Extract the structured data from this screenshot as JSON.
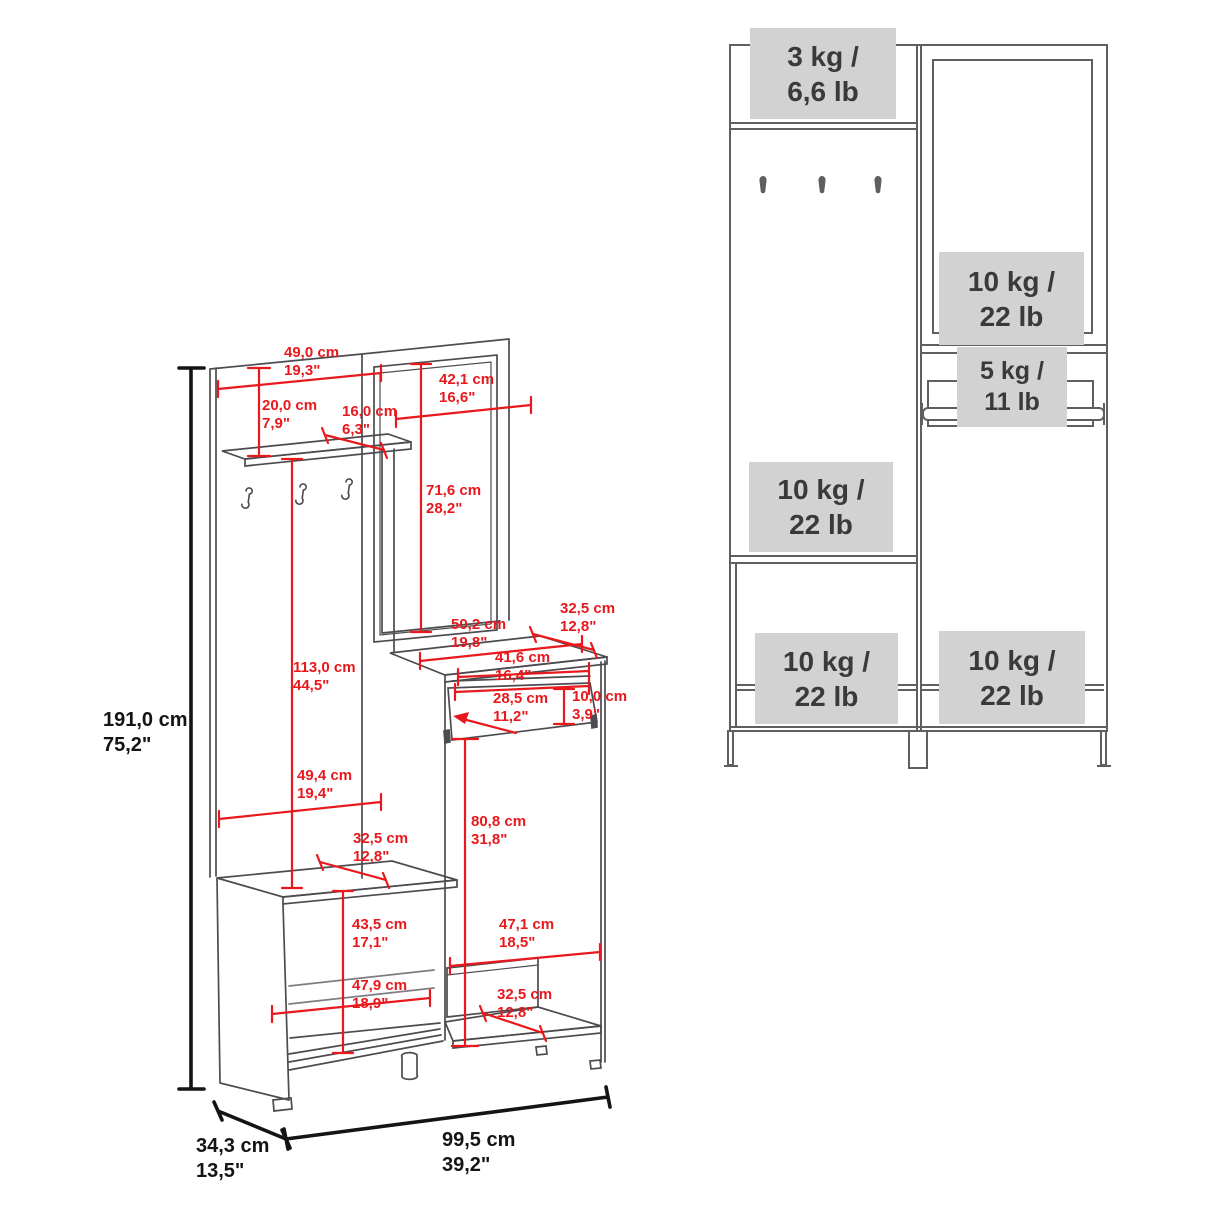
{
  "page": {
    "background": "#ffffff",
    "type": "furniture dimension and weight-capacity diagram"
  },
  "colors": {
    "dimension_red": "#e8181d",
    "overall_dimension_black": "#141414",
    "left_linework": "#4c4b4f",
    "right_linework": "#5e5f61",
    "capacity_box_bg": "#d2d2d3",
    "capacity_text": "#3a3a3c"
  },
  "left_diagram": {
    "description": "perspective drawing of hall tree with red dimension lines",
    "dimensions": [
      {
        "id": "top_panel_width",
        "cm": "49,0 cm",
        "in": "19,3\""
      },
      {
        "id": "shelf_drop",
        "cm": "20,0 cm",
        "in": "7,9\""
      },
      {
        "id": "shelf_depth",
        "cm": "16,0 cm",
        "in": "6,3\""
      },
      {
        "id": "mirror_width",
        "cm": "42,1 cm",
        "in": "16,6\""
      },
      {
        "id": "mirror_height",
        "cm": "71,6 cm",
        "in": "28,2\""
      },
      {
        "id": "panel_height",
        "cm": "113,0 cm",
        "in": "44,5\""
      },
      {
        "id": "total_height",
        "cm": "191,0 cm",
        "in": "75,2\""
      },
      {
        "id": "cabinet_top_width",
        "cm": "50,2 cm",
        "in": "19,8\""
      },
      {
        "id": "cabinet_top_depth",
        "cm": "32,5 cm",
        "in": "12,8\""
      },
      {
        "id": "compartment_width",
        "cm": "41,6 cm",
        "in": "16,4\""
      },
      {
        "id": "compartment_door_width",
        "cm": "28,5 cm",
        "in": "11,2\""
      },
      {
        "id": "compartment_height",
        "cm": "10,0 cm",
        "in": "3,9\""
      },
      {
        "id": "bench_width",
        "cm": "49,4 cm",
        "in": "19,4\""
      },
      {
        "id": "bench_depth",
        "cm": "32,5 cm",
        "in": "12,8\""
      },
      {
        "id": "cabinet_height",
        "cm": "80,8 cm",
        "in": "31,8\""
      },
      {
        "id": "bench_clearance",
        "cm": "43,5 cm",
        "in": "17,1\""
      },
      {
        "id": "lower_right_width",
        "cm": "47,1 cm",
        "in": "18,5\""
      },
      {
        "id": "lower_back_width",
        "cm": "47,9 cm",
        "in": "18,9\""
      },
      {
        "id": "bottom_shelf_depth",
        "cm": "32,5 cm",
        "in": "12,8\""
      },
      {
        "id": "overall_depth",
        "cm": "34,3 cm",
        "in": "13,5\""
      },
      {
        "id": "overall_width",
        "cm": "99,5 cm",
        "in": "39,2\""
      }
    ]
  },
  "right_diagram": {
    "description": "front view with maximum load capacity per surface",
    "capacities": [
      {
        "id": "top_shelf",
        "kg": "3 kg /",
        "lb": "6,6 lb"
      },
      {
        "id": "mirror_cabinet",
        "kg": "10 kg /",
        "lb": "22 lb"
      },
      {
        "id": "hanging_rod",
        "kg": "5 kg /",
        "lb": "11 lb"
      },
      {
        "id": "bench_seat",
        "kg": "10 kg /",
        "lb": "22 lb"
      },
      {
        "id": "bottom_left_shelf",
        "kg": "10 kg /",
        "lb": "22 lb"
      },
      {
        "id": "bottom_right_shelf",
        "kg": "10 kg /",
        "lb": "22 lb"
      }
    ]
  }
}
